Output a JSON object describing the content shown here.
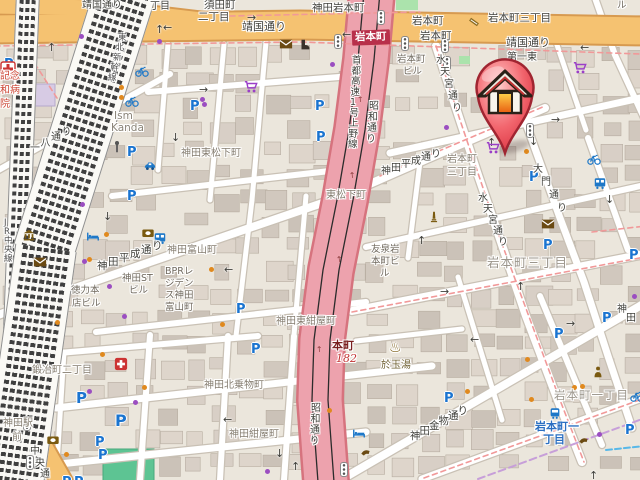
{
  "map": {
    "station_badge": "岩本町",
    "marker_name": "home-location-marker",
    "labels": [
      {
        "t": "靖国通り",
        "x": 82,
        "y": 1,
        "s": 10,
        "c": "road"
      },
      {
        "t": "靖国通り",
        "x": 242,
        "y": 21,
        "s": 11,
        "c": "road"
      },
      {
        "t": "靖国通り",
        "x": 506,
        "y": 37,
        "s": 11,
        "c": "road"
      },
      {
        "t": "丁目",
        "x": 150,
        "y": 2,
        "s": 10,
        "c": "road"
      },
      {
        "t": "須田町",
        "x": 204,
        "y": 0,
        "s": 10.5,
        "c": "road"
      },
      {
        "t": "二丁目",
        "x": 198,
        "y": 12,
        "s": 10.5,
        "c": "road"
      },
      {
        "t": "神田岩本町",
        "x": 312,
        "y": 3,
        "s": 10.5,
        "c": "road"
      },
      {
        "t": "岩本町",
        "x": 412,
        "y": 16,
        "s": 10.5,
        "c": "road"
      },
      {
        "t": "岩本町",
        "x": 420,
        "y": 31,
        "s": 10.5,
        "c": "road"
      },
      {
        "t": "岩本町三丁目",
        "x": 488,
        "y": 13,
        "s": 10.5,
        "c": "road"
      },
      {
        "t": "第一東",
        "x": 507,
        "y": 53,
        "s": 10,
        "c": "road"
      },
      {
        "t": "ル",
        "x": 617,
        "y": 1,
        "s": 9.5,
        "c": "bldg"
      },
      {
        "t": "岩本町",
        "x": 397,
        "y": 55,
        "s": 9.5,
        "c": "bldg"
      },
      {
        "t": "ビル",
        "x": 403,
        "y": 67,
        "s": 9.5,
        "c": "bldg"
      },
      {
        "t": "岩本町",
        "x": 447,
        "y": 155,
        "s": 10,
        "c": "area"
      },
      {
        "t": "三丁目",
        "x": 447,
        "y": 168,
        "s": 10,
        "c": "area"
      },
      {
        "t": "東松下町",
        "x": 326,
        "y": 191,
        "s": 10,
        "c": "area"
      },
      {
        "t": "神田東松下町",
        "x": 181,
        "y": 149,
        "s": 10,
        "c": "area"
      },
      {
        "t": "神田富山町",
        "x": 167,
        "y": 246,
        "s": 10,
        "c": "area"
      },
      {
        "t": "神田ST",
        "x": 122,
        "y": 274,
        "s": 9.5,
        "c": "bldg"
      },
      {
        "t": "ビル",
        "x": 129,
        "y": 286,
        "s": 9.5,
        "c": "bldg"
      },
      {
        "t": "BPRレ",
        "x": 165,
        "y": 267,
        "s": 9.5,
        "c": "bldg"
      },
      {
        "t": "ジデン",
        "x": 165,
        "y": 279,
        "s": 9.5,
        "c": "bldg"
      },
      {
        "t": "ス神田",
        "x": 165,
        "y": 291,
        "s": 9.5,
        "c": "bldg"
      },
      {
        "t": "富山町",
        "x": 165,
        "y": 303,
        "s": 9.5,
        "c": "bldg"
      },
      {
        "t": "徳力本",
        "x": 71,
        "y": 286,
        "s": 9.5,
        "c": "bldg"
      },
      {
        "t": "店ビル",
        "x": 72,
        "y": 299,
        "s": 9.5,
        "c": "bldg"
      },
      {
        "t": "Ism",
        "x": 114,
        "y": 111,
        "s": 10.5,
        "c": "en"
      },
      {
        "t": "Kanda",
        "x": 111,
        "y": 123,
        "s": 10.5,
        "c": "en"
      },
      {
        "t": "記念",
        "x": 0,
        "y": 72,
        "s": 10,
        "c": "hosp"
      },
      {
        "t": "和病",
        "x": 0,
        "y": 86,
        "s": 10,
        "c": "hosp"
      },
      {
        "t": "院",
        "x": 0,
        "y": 100,
        "s": 10,
        "c": "hosp"
      },
      {
        "t": "鍛冶町二丁目",
        "x": 32,
        "y": 366,
        "s": 10,
        "c": "area"
      },
      {
        "t": "神田北乗物町",
        "x": 204,
        "y": 381,
        "s": 10,
        "c": "area"
      },
      {
        "t": "神田紺屋町",
        "x": 229,
        "y": 430,
        "s": 10,
        "c": "area"
      },
      {
        "t": "神田東紺屋町",
        "x": 276,
        "y": 317,
        "s": 10,
        "c": "area"
      },
      {
        "t": "於玉湯",
        "x": 381,
        "y": 361,
        "s": 10,
        "c": "poi"
      },
      {
        "t": "本町",
        "x": 332,
        "y": 340,
        "s": 11,
        "c": "route1"
      },
      {
        "t": "182",
        "x": 336,
        "y": 353,
        "s": 11,
        "c": "route2"
      },
      {
        "t": "岩本町三丁目",
        "x": 487,
        "y": 257,
        "s": 12.5,
        "c": "arealg"
      },
      {
        "t": "岩本町一丁目",
        "x": 554,
        "y": 390,
        "s": 11.5,
        "c": "arealg"
      },
      {
        "t": "岩本町一",
        "x": 535,
        "y": 421,
        "s": 11,
        "c": "blue"
      },
      {
        "t": "丁目",
        "x": 543,
        "y": 434,
        "s": 11,
        "c": "blue"
      },
      {
        "t": "神田駅",
        "x": 3,
        "y": 419,
        "s": 10,
        "c": "area"
      },
      {
        "t": "前",
        "x": 12,
        "y": 433,
        "s": 10,
        "c": "area"
      },
      {
        "t": "友泉岩",
        "x": 371,
        "y": 245,
        "s": 9.5,
        "c": "bldg"
      },
      {
        "t": "本町ビ",
        "x": 371,
        "y": 257,
        "s": 9.5,
        "c": "bldg"
      },
      {
        "t": "ル",
        "x": 380,
        "y": 269,
        "s": 9.5,
        "c": "bldg"
      },
      {
        "t": "水天宮通り",
        "x": 436,
        "y": 56,
        "s": 10,
        "c": "road",
        "dx": 4,
        "dy": 12
      },
      {
        "t": "水天宮通り",
        "x": 478,
        "y": 194,
        "s": 10,
        "c": "road",
        "dx": 5,
        "dy": 11
      },
      {
        "t": "大門通り",
        "x": 533,
        "y": 165,
        "s": 10,
        "c": "road",
        "dx": 8,
        "dy": 13
      },
      {
        "t": "首都高速1号上野線",
        "x": 352,
        "y": 56,
        "s": 9.5,
        "c": "road",
        "dx": -0.5,
        "dy": 10.5
      },
      {
        "t": "昭和通り",
        "x": 369,
        "y": 102,
        "s": 10,
        "c": "road",
        "dx": -1,
        "dy": 11
      },
      {
        "t": "昭和通り",
        "x": 311,
        "y": 404,
        "s": 10,
        "c": "road",
        "dx": -0.5,
        "dy": 11
      },
      {
        "t": "神田平成通り",
        "x": 97,
        "y": 261,
        "s": 10.5,
        "c": "road",
        "dx": 11,
        "dy": -4
      },
      {
        "t": "神田平成通り",
        "x": 381,
        "y": 167,
        "s": 10,
        "c": "road",
        "dx": 10,
        "dy": -3.5
      },
      {
        "t": "一八通り",
        "x": 30,
        "y": 144,
        "s": 10,
        "c": "road",
        "dx": 10.5,
        "dy": -5.5
      },
      {
        "t": "中央通り",
        "x": 30,
        "y": 447,
        "s": 10,
        "c": "road",
        "dx": 5,
        "dy": 11.5
      },
      {
        "t": "神田金物通り",
        "x": 410,
        "y": 431,
        "s": 10.5,
        "c": "road",
        "dx": 9.5,
        "dy": -5
      },
      {
        "t": "神田",
        "x": 617,
        "y": 305,
        "s": 10,
        "c": "road",
        "dx": 9,
        "dy": 9
      },
      {
        "t": "JR中央線",
        "x": 4,
        "y": 219,
        "s": 8.5,
        "c": "rail-t",
        "dx": 0,
        "dy": 9
      },
      {
        "t": "東北新幹線",
        "x": 118,
        "y": 34,
        "s": 8.5,
        "c": "rail-t",
        "dx": -2.5,
        "dy": 10
      }
    ],
    "parking_glyph": "P",
    "parkings": [
      {
        "x": 4,
        "y": 58
      },
      {
        "x": 190,
        "y": 100
      },
      {
        "x": 127,
        "y": 146
      },
      {
        "x": 315,
        "y": 100
      },
      {
        "x": 316,
        "y": 131
      },
      {
        "x": 127,
        "y": 190
      },
      {
        "x": 529,
        "y": 171
      },
      {
        "x": 543,
        "y": 239
      },
      {
        "x": 629,
        "y": 249
      },
      {
        "x": 602,
        "y": 312
      },
      {
        "x": 554,
        "y": 328
      },
      {
        "x": 444,
        "y": 392
      },
      {
        "x": 76,
        "y": 391,
        "s": 15
      },
      {
        "x": 115,
        "y": 413,
        "s": 16
      },
      {
        "x": 95,
        "y": 436
      },
      {
        "x": 98,
        "y": 449
      },
      {
        "x": 236,
        "y": 303
      },
      {
        "x": 251,
        "y": 343
      },
      {
        "x": 62,
        "y": 476
      },
      {
        "x": 74,
        "y": 476
      },
      {
        "x": 625,
        "y": 424
      }
    ],
    "icons": [
      {
        "k": "bike",
        "x": 142,
        "y": 71
      },
      {
        "k": "bike",
        "x": 132,
        "y": 101
      },
      {
        "k": "bike",
        "x": 594,
        "y": 159
      },
      {
        "k": "bike",
        "x": 637,
        "y": 396
      },
      {
        "k": "bus",
        "x": 160,
        "y": 238
      },
      {
        "k": "bus",
        "x": 600,
        "y": 183
      },
      {
        "k": "car",
        "x": 150,
        "y": 166
      },
      {
        "k": "bed",
        "x": 93,
        "y": 237
      },
      {
        "k": "bed",
        "x": 359,
        "y": 434
      },
      {
        "k": "train",
        "x": 555,
        "y": 413
      },
      {
        "k": "phone",
        "x": 366,
        "y": 454
      },
      {
        "k": "phone",
        "x": 584,
        "y": 442
      },
      {
        "k": "cart",
        "x": 251,
        "y": 87
      },
      {
        "k": "cart",
        "x": 580,
        "y": 68
      },
      {
        "k": "cart",
        "x": 493,
        "y": 148
      },
      {
        "k": "mail",
        "x": 286,
        "y": 44
      },
      {
        "k": "mail",
        "x": 40,
        "y": 262
      },
      {
        "k": "mail",
        "x": 548,
        "y": 224
      },
      {
        "k": "bank",
        "x": 29,
        "y": 235
      },
      {
        "k": "atm",
        "x": 148,
        "y": 233
      },
      {
        "k": "atm",
        "x": 53,
        "y": 440
      },
      {
        "k": "bath",
        "x": 396,
        "y": 349
      },
      {
        "k": "monument",
        "x": 434,
        "y": 217
      },
      {
        "k": "person",
        "x": 598,
        "y": 372
      },
      {
        "k": "boot",
        "x": 305,
        "y": 45
      },
      {
        "k": "shop",
        "x": 474,
        "y": 22
      },
      {
        "k": "hospital",
        "x": 8,
        "y": 69,
        "s": 16
      },
      {
        "k": "clinic",
        "x": 121,
        "y": 364
      },
      {
        "k": "pole",
        "x": 117,
        "y": 147
      }
    ],
    "signals": [
      {
        "x": 334,
        "y": 34
      },
      {
        "x": 401,
        "y": 36
      },
      {
        "x": 441,
        "y": 38
      },
      {
        "x": 443,
        "y": 56
      },
      {
        "x": 526,
        "y": 123
      },
      {
        "x": 23,
        "y": 416
      },
      {
        "x": 26,
        "y": 455
      },
      {
        "x": 340,
        "y": 462
      },
      {
        "x": 377,
        "y": 10
      }
    ],
    "dots": [
      {
        "c": "orange",
        "x": 119,
        "y": 85
      },
      {
        "c": "orange",
        "x": 119,
        "y": 95
      },
      {
        "c": "orange",
        "x": 524,
        "y": 149
      },
      {
        "c": "orange",
        "x": 572,
        "y": 385
      },
      {
        "c": "orange",
        "x": 580,
        "y": 384
      },
      {
        "c": "orange",
        "x": 525,
        "y": 357
      },
      {
        "c": "orange",
        "x": 465,
        "y": 389
      },
      {
        "c": "orange",
        "x": 529,
        "y": 397
      },
      {
        "c": "orange",
        "x": 55,
        "y": 320
      },
      {
        "c": "orange",
        "x": 100,
        "y": 352
      },
      {
        "c": "orange",
        "x": 142,
        "y": 385
      },
      {
        "c": "orange",
        "x": 220,
        "y": 322
      },
      {
        "c": "orange",
        "x": 64,
        "y": 452
      },
      {
        "c": "orange",
        "x": 104,
        "y": 232
      },
      {
        "c": "orange",
        "x": 209,
        "y": 267
      },
      {
        "c": "orange",
        "x": 87,
        "y": 257
      },
      {
        "c": "orange",
        "x": 327,
        "y": 408
      },
      {
        "c": "purple",
        "x": 79,
        "y": 34
      },
      {
        "c": "purple",
        "x": 157,
        "y": 39
      },
      {
        "c": "purple",
        "x": 200,
        "y": 97
      },
      {
        "c": "purple",
        "x": 202,
        "y": 102
      },
      {
        "c": "purple",
        "x": 330,
        "y": 62
      },
      {
        "c": "purple",
        "x": 444,
        "y": 125
      },
      {
        "c": "purple",
        "x": 632,
        "y": 294
      },
      {
        "c": "purple",
        "x": 597,
        "y": 432
      },
      {
        "c": "purple",
        "x": 122,
        "y": 314
      },
      {
        "c": "purple",
        "x": 87,
        "y": 389
      },
      {
        "c": "purple",
        "x": 80,
        "y": 202
      },
      {
        "c": "purple",
        "x": 107,
        "y": 284
      },
      {
        "c": "purple",
        "x": 82,
        "y": 259
      },
      {
        "c": "purple",
        "x": 265,
        "y": 469
      },
      {
        "c": "purple",
        "x": 133,
        "y": 400
      }
    ],
    "arrows": [
      {
        "g": "→",
        "x": 247,
        "y": 12
      },
      {
        "g": "←",
        "x": 342,
        "y": 29
      },
      {
        "g": "←",
        "x": 163,
        "y": 22
      },
      {
        "g": "↑",
        "x": 155,
        "y": 24
      },
      {
        "g": "→",
        "x": 199,
        "y": 84
      },
      {
        "g": "↓",
        "x": 171,
        "y": 132
      },
      {
        "g": "←",
        "x": 224,
        "y": 264
      },
      {
        "g": "↓",
        "x": 103,
        "y": 211
      },
      {
        "g": "↑",
        "x": 47,
        "y": 42
      },
      {
        "g": "←",
        "x": 580,
        "y": 42
      },
      {
        "g": "→",
        "x": 551,
        "y": 114
      },
      {
        "g": "↑",
        "x": 487,
        "y": 137
      },
      {
        "g": "↓",
        "x": 529,
        "y": 136
      },
      {
        "g": "↓",
        "x": 605,
        "y": 194
      },
      {
        "g": "↑",
        "x": 417,
        "y": 235
      },
      {
        "g": "→",
        "x": 440,
        "y": 286
      },
      {
        "g": "←",
        "x": 470,
        "y": 334
      },
      {
        "g": "↑",
        "x": 516,
        "y": 281
      },
      {
        "g": "←",
        "x": 223,
        "y": 414
      },
      {
        "g": "↓",
        "x": 275,
        "y": 448
      },
      {
        "g": "↑",
        "x": 589,
        "y": 470
      },
      {
        "g": "→",
        "x": 566,
        "y": 318
      },
      {
        "g": "↑",
        "x": 291,
        "y": 461
      }
    ],
    "hw_arrows": [
      {
        "g": "↑",
        "x": 357,
        "y": 96,
        "r": -4
      },
      {
        "g": "↑",
        "x": 349,
        "y": 172,
        "r": -5
      },
      {
        "g": "↑",
        "x": 336,
        "y": 256,
        "r": -7
      },
      {
        "g": "↑",
        "x": 316,
        "y": 346,
        "r": -4
      },
      {
        "g": "↑",
        "x": 313,
        "y": 420,
        "r": -2
      }
    ],
    "colors": {
      "marker_red": "#e03c46",
      "road_orange": "#f5c271",
      "trunk_pink": "#eda2ad",
      "parking_blue": "#1a74d0",
      "poi_purple": "#9b3fc8",
      "poi_brown": "#7a5a10",
      "boundary_red": "#f19999",
      "station_badge_bg": "#b8304a"
    }
  }
}
